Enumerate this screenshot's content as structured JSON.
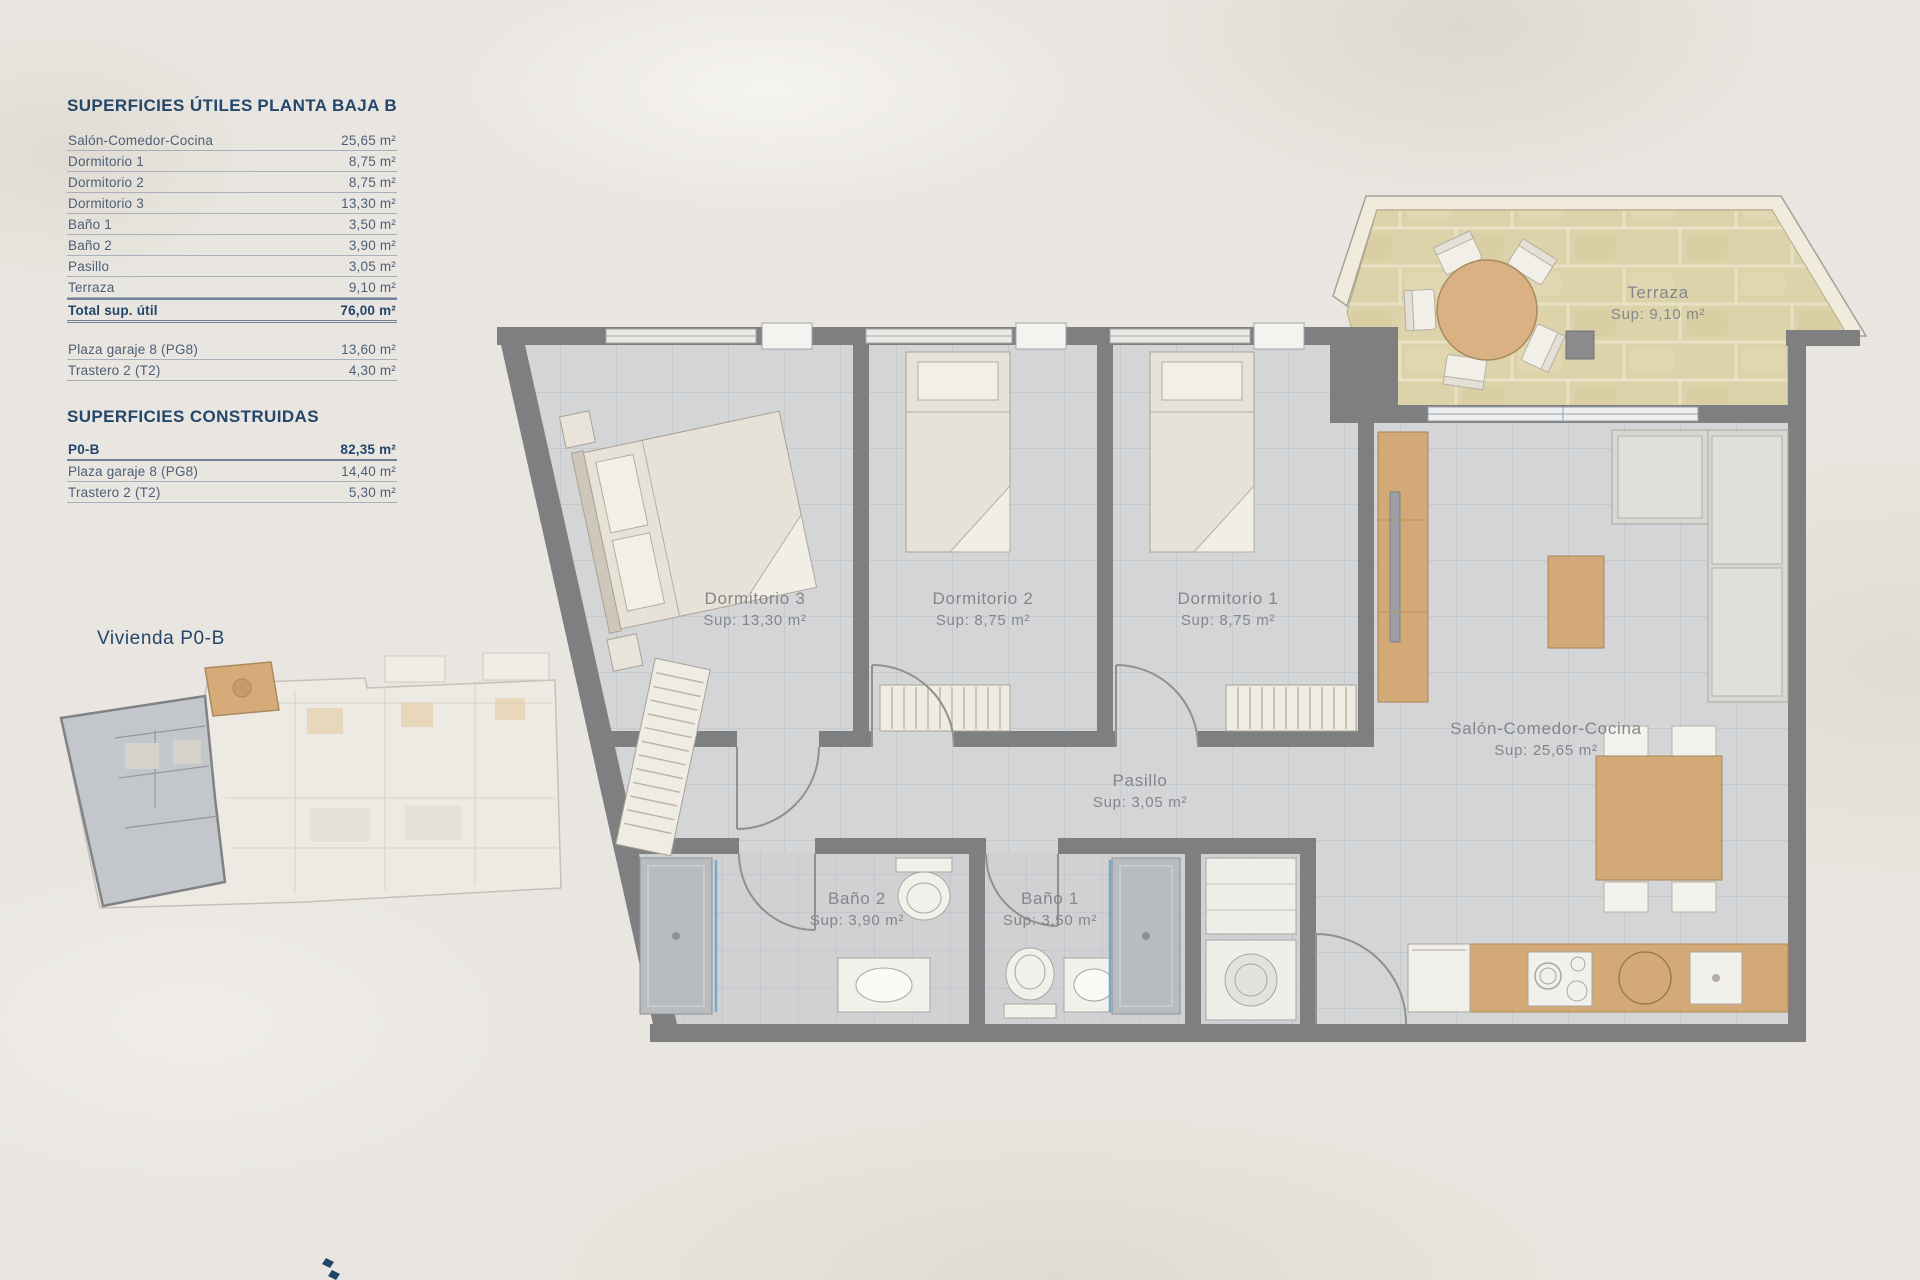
{
  "tables": {
    "useful": {
      "title": "SUPERFICIES ÚTILES",
      "floor": "PLANTA BAJA B",
      "rows": [
        {
          "label": "Salón-Comedor-Cocina",
          "value": "25,65 m²"
        },
        {
          "label": "Dormitorio 1",
          "value": "8,75 m²"
        },
        {
          "label": "Dormitorio 2",
          "value": "8,75 m²"
        },
        {
          "label": "Dormitorio 3",
          "value": "13,30 m²"
        },
        {
          "label": "Baño 1",
          "value": "3,50 m²"
        },
        {
          "label": "Baño 2",
          "value": "3,90 m²"
        },
        {
          "label": "Pasillo",
          "value": "3,05 m²"
        },
        {
          "label": "Terraza",
          "value": "9,10 m²"
        }
      ],
      "total": {
        "label": "Total sup. útil",
        "value": "76,00 m²"
      },
      "annex_rows": [
        {
          "label": "Plaza garaje 8 (PG8)",
          "value": "13,60 m²"
        },
        {
          "label": "Trastero 2 (T2)",
          "value": "4,30 m²"
        }
      ]
    },
    "built": {
      "title": "SUPERFICIES CONSTRUIDAS",
      "rows": [
        {
          "label": "P0-B",
          "value": "82,35 m²"
        },
        {
          "label": "Plaza garaje 8 (PG8)",
          "value": "14,40 m²"
        },
        {
          "label": "Trastero 2 (T2)",
          "value": "5,30 m²"
        }
      ]
    }
  },
  "mini_plan": {
    "label": "Vivienda P0-B"
  },
  "plan": {
    "rooms": [
      {
        "name": "Dormitorio 3",
        "sup": "Sup: 13,30 m²"
      },
      {
        "name": "Dormitorio 2",
        "sup": "Sup: 8,75 m²"
      },
      {
        "name": "Dormitorio 1",
        "sup": "Sup: 8,75 m²"
      },
      {
        "name": "Pasillo",
        "sup": "Sup: 3,05 m²"
      },
      {
        "name": "Baño 2",
        "sup": "Sup: 3,90 m²"
      },
      {
        "name": "Baño 1",
        "sup": "Sup: 3,50 m²"
      },
      {
        "name": "Salón-Comedor-Cocina",
        "sup": "Sup: 25,65 m²"
      },
      {
        "name": "Terraza",
        "sup": "Sup: 9,10 m²"
      }
    ]
  },
  "colors": {
    "accent_navy": "#24466b",
    "wall_gray": "#7d7f81",
    "terrace_tan": "#ddd3ab",
    "wood": "#d3aa77",
    "floor_tile": "#d3d5d7"
  }
}
